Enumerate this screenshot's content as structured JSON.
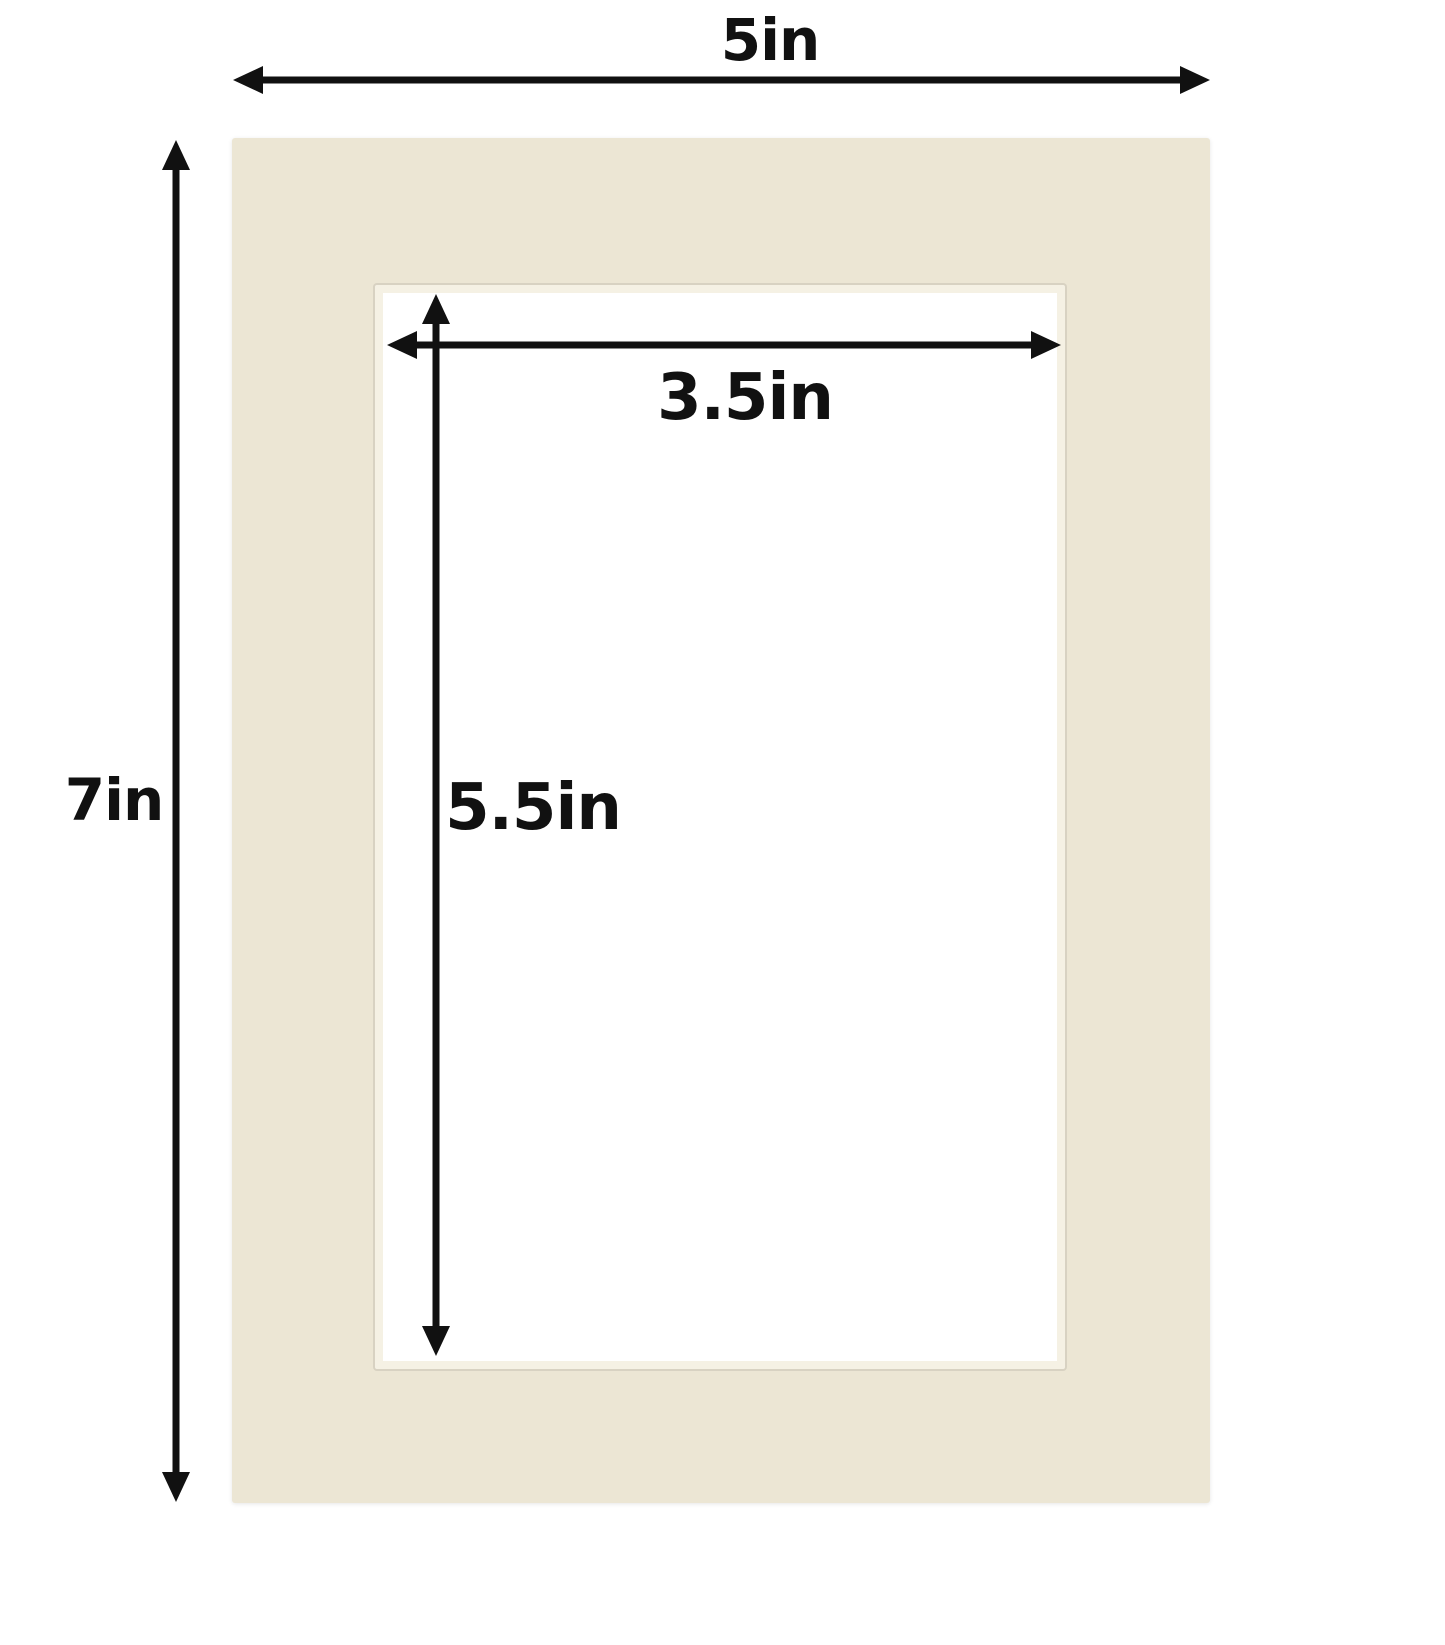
{
  "page": {
    "background": "#ffffff"
  },
  "diagram": {
    "description": "Picture frame mat board dimension diagram",
    "arrow_color": "#111111",
    "mat": {
      "color": "#ece6d4",
      "bevel_color": "#f5f1e4",
      "bevel_edge_color": "#d8d2c2",
      "opening_background": "#ffffff"
    },
    "dimensions": {
      "outer_width": {
        "label": "5in"
      },
      "outer_height": {
        "label": "7in"
      },
      "opening_width": {
        "label": "3.5in"
      },
      "opening_height": {
        "label": "5.5in"
      }
    }
  }
}
